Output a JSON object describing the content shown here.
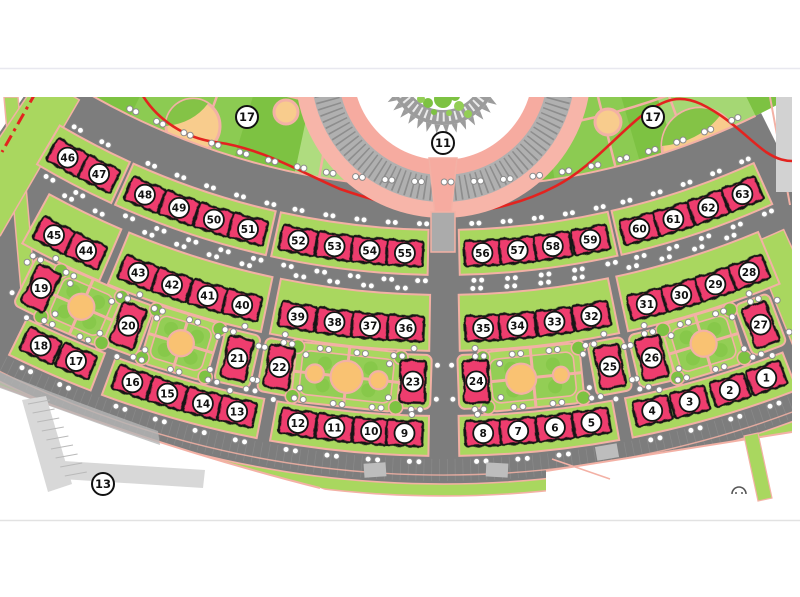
{
  "palette": {
    "road_gray": "#7d7d7d",
    "road_light": "#b2b2b2",
    "park_green": "#7dc242",
    "park_green_alt": "#8ccb52",
    "pale_green": "#b7e08a",
    "parcel_green": "#a9d75f",
    "leaf_green": "#93ce55",
    "curb_pink": "#f3b1a5",
    "plaza_pink": "#f6aba0",
    "plaza_pale_pink": "#f7b5a9",
    "building_pink": "#ee3e6e",
    "outline_black": "#191919",
    "orange": "#f9c272",
    "red_line": "#e3231f",
    "hatch_gray": "#8f8f8f",
    "plot_gray": "#d8d8d8",
    "frame_line_top": "#e8e8ef",
    "frame_line_bottom": "#e2e2e2",
    "white": "#ffffff"
  },
  "zone_labels": [
    {
      "label": "17",
      "x": 247,
      "y": 117
    },
    {
      "label": "11",
      "x": 443,
      "y": 143
    },
    {
      "label": "17",
      "x": 653,
      "y": 117
    },
    {
      "label": "13",
      "x": 103,
      "y": 484
    }
  ],
  "partial_marker": {
    "x": 739,
    "y": 494
  },
  "building_rows": [
    {
      "name": "arc-row-1",
      "radius": 779,
      "orient": "tangential",
      "blocks": [
        [
          {
            "n": "46",
            "deg": -28.8
          },
          {
            "n": "47",
            "deg": -26.2
          }
        ],
        [
          {
            "n": "48",
            "deg": -22.5
          },
          {
            "n": "49",
            "deg": -19.8
          },
          {
            "n": "50",
            "deg": -17.1
          },
          {
            "n": "51",
            "deg": -14.5
          }
        ],
        [
          {
            "n": "52",
            "deg": -10.7
          },
          {
            "n": "53",
            "deg": -8.0
          },
          {
            "n": "54",
            "deg": -5.4
          },
          {
            "n": "55",
            "deg": -2.8
          }
        ],
        [
          {
            "n": "56",
            "deg": 2.9
          },
          {
            "n": "57",
            "deg": 5.5
          },
          {
            "n": "58",
            "deg": 8.1
          },
          {
            "n": "59",
            "deg": 10.9
          }
        ],
        [
          {
            "n": "60",
            "deg": 14.6
          },
          {
            "n": "61",
            "deg": 17.2
          },
          {
            "n": "62",
            "deg": 19.9
          },
          {
            "n": "63",
            "deg": 22.6
          }
        ]
      ]
    },
    {
      "name": "arc-row-2",
      "radius": 854,
      "orient": "tangential",
      "blocks": [
        [
          {
            "n": "45",
            "deg": -27.1
          },
          {
            "n": "44",
            "deg": -24.7
          }
        ],
        [
          {
            "n": "43",
            "deg": -20.9
          },
          {
            "n": "42",
            "deg": -18.5
          },
          {
            "n": "41",
            "deg": -16.0
          },
          {
            "n": "40",
            "deg": -13.6
          }
        ],
        [
          {
            "n": "39",
            "deg": -9.8
          },
          {
            "n": "38",
            "deg": -7.3
          },
          {
            "n": "37",
            "deg": -4.9
          },
          {
            "n": "36",
            "deg": -2.5
          }
        ],
        [
          {
            "n": "35",
            "deg": 2.7
          },
          {
            "n": "34",
            "deg": 5.0
          },
          {
            "n": "33",
            "deg": 7.5
          },
          {
            "n": "32",
            "deg": 10.0
          }
        ],
        [
          {
            "n": "31",
            "deg": 13.8
          },
          {
            "n": "30",
            "deg": 16.2
          },
          {
            "n": "29",
            "deg": 18.6
          },
          {
            "n": "28",
            "deg": 21.0
          }
        ]
      ]
    },
    {
      "name": "arc-row-3-singles",
      "radius": 907,
      "orient": "radial",
      "blocks": [
        [
          {
            "n": "19",
            "deg": -26.3
          }
        ],
        [
          {
            "n": "20",
            "deg": -20.3
          }
        ],
        [
          {
            "n": "21",
            "deg": -13.1
          }
        ],
        [
          {
            "n": "22",
            "deg": -10.4
          }
        ],
        [
          {
            "n": "23",
            "deg": -1.9
          }
        ],
        [
          {
            "n": "24",
            "deg": 2.1
          }
        ],
        [
          {
            "n": "25",
            "deg": 10.6
          }
        ],
        [
          {
            "n": "26",
            "deg": 13.3
          }
        ],
        [
          {
            "n": "27",
            "deg": 20.5
          }
        ]
      ]
    },
    {
      "name": "arc-row-4",
      "radius": 959,
      "orient": "tangential",
      "blocks": [
        [
          {
            "n": "18",
            "deg": -24.8
          },
          {
            "n": "17",
            "deg": -22.5
          }
        ],
        [
          {
            "n": "16",
            "deg": -18.9
          },
          {
            "n": "15",
            "deg": -16.7
          },
          {
            "n": "14",
            "deg": -14.5
          },
          {
            "n": "13",
            "deg": -12.4
          }
        ],
        [
          {
            "n": "12",
            "deg": -8.7
          },
          {
            "n": "11",
            "deg": -6.5
          },
          {
            "n": "10",
            "deg": -4.3
          },
          {
            "n": "9",
            "deg": -2.3
          }
        ],
        [
          {
            "n": "8",
            "deg": 2.4
          },
          {
            "n": "7",
            "deg": 4.5
          },
          {
            "n": "6",
            "deg": 6.7
          },
          {
            "n": "5",
            "deg": 8.9
          }
        ],
        [
          {
            "n": "4",
            "deg": 12.6
          },
          {
            "n": "3",
            "deg": 14.9
          },
          {
            "n": "2",
            "deg": 17.4
          },
          {
            "n": "1",
            "deg": 19.7
          }
        ]
      ]
    }
  ],
  "courtyards": [
    {
      "deg": -23.5,
      "w": 54,
      "circles": 1
    },
    {
      "deg": -16.8,
      "w": 54,
      "circles": 1
    },
    {
      "deg": -6.1,
      "w": 92,
      "circles": 3
    },
    {
      "deg": 5.7,
      "w": 84,
      "circles": 2
    },
    {
      "deg": 16.7,
      "w": 58,
      "circles": 1
    }
  ]
}
